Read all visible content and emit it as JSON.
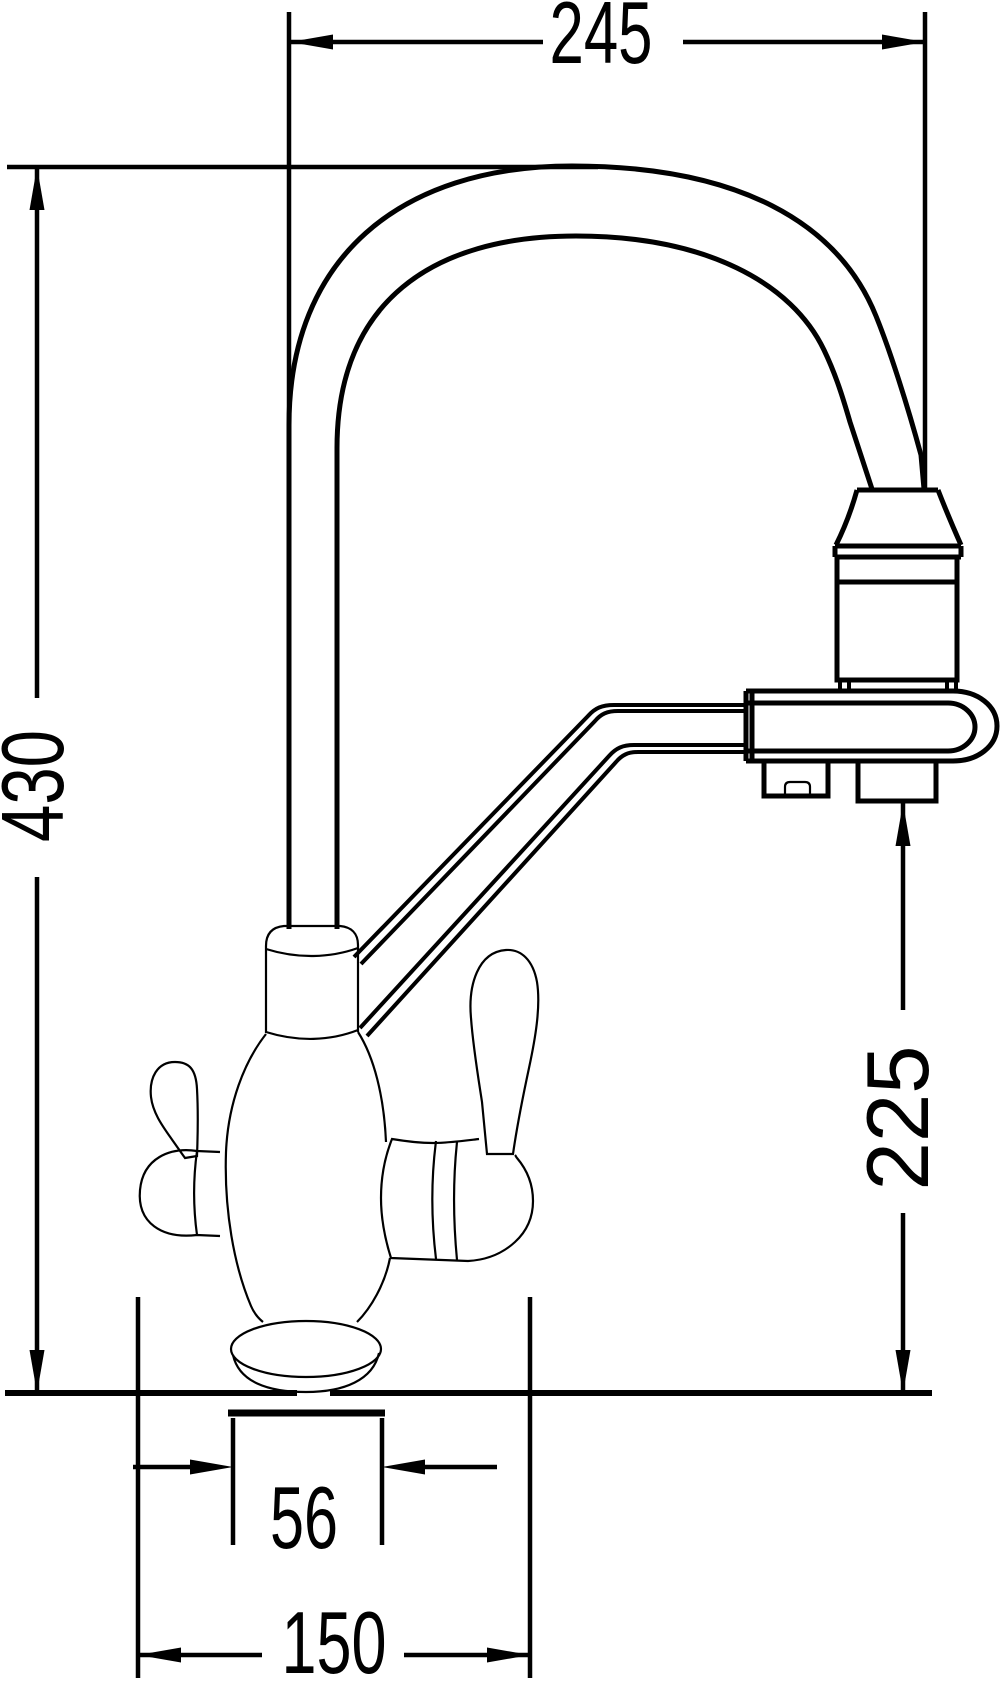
{
  "drawing": {
    "background_color": "#ffffff",
    "line_color": "#000000",
    "dimensions": {
      "spout_reach": {
        "label": "245"
      },
      "overall_height": {
        "label": "430"
      },
      "outlet_height": {
        "label": "225"
      },
      "base_diameter": {
        "label": "56"
      },
      "mounting_width": {
        "label": "150"
      }
    }
  }
}
